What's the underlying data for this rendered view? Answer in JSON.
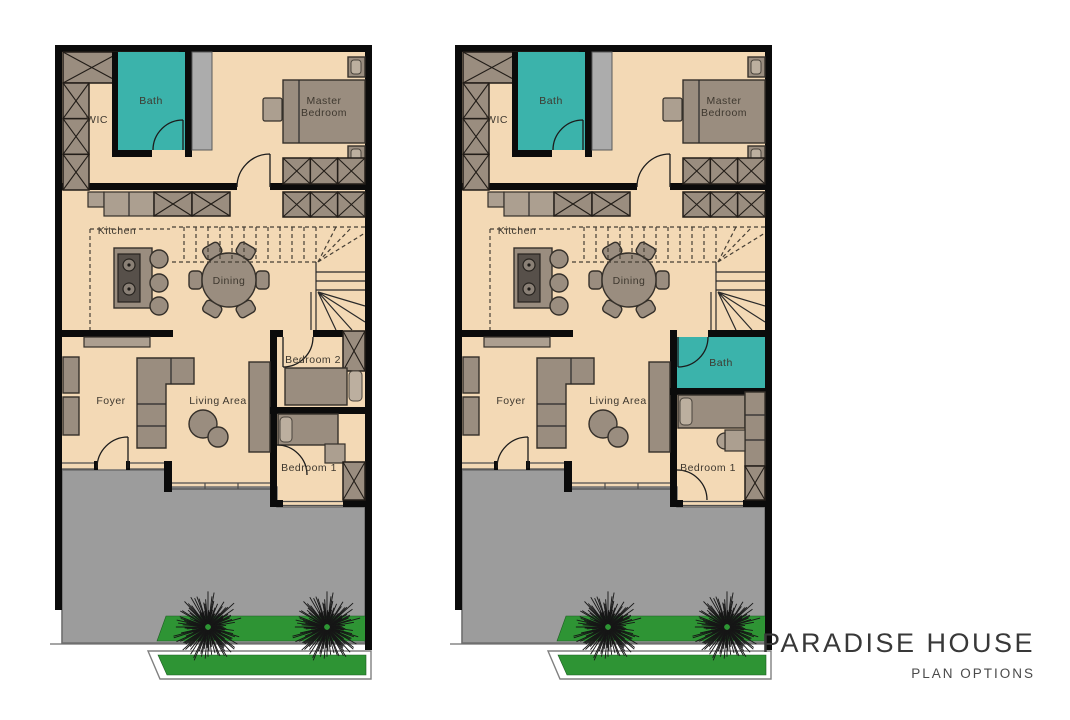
{
  "title": "PARADISE HOUSE",
  "subtitle": "PLAN OPTIONS",
  "colors": {
    "floor": "#F3D9B5",
    "wall": "#0b0b0b",
    "furniture": "#9A8D7F",
    "bath": "#3BB3AB",
    "patio": "#9C9C9C",
    "grass": "#2E9434"
  },
  "shared_rooms": {
    "wic": "WIC",
    "bath": "Bath",
    "master_line1": "Master",
    "master_line2": "Bedroom",
    "kitchen": "Kitchen",
    "dining": "Dining",
    "foyer": "Foyer",
    "living": "Living Area"
  },
  "plan_options": [
    {
      "id": "plan-option-1",
      "rooms": {
        "bedroom2": "Bedroom 2",
        "bedroom1": "Bedroom 1"
      }
    },
    {
      "id": "plan-option-2",
      "rooms": {
        "bath2": "Bath",
        "bedroom1": "Bedroom 1"
      }
    }
  ]
}
